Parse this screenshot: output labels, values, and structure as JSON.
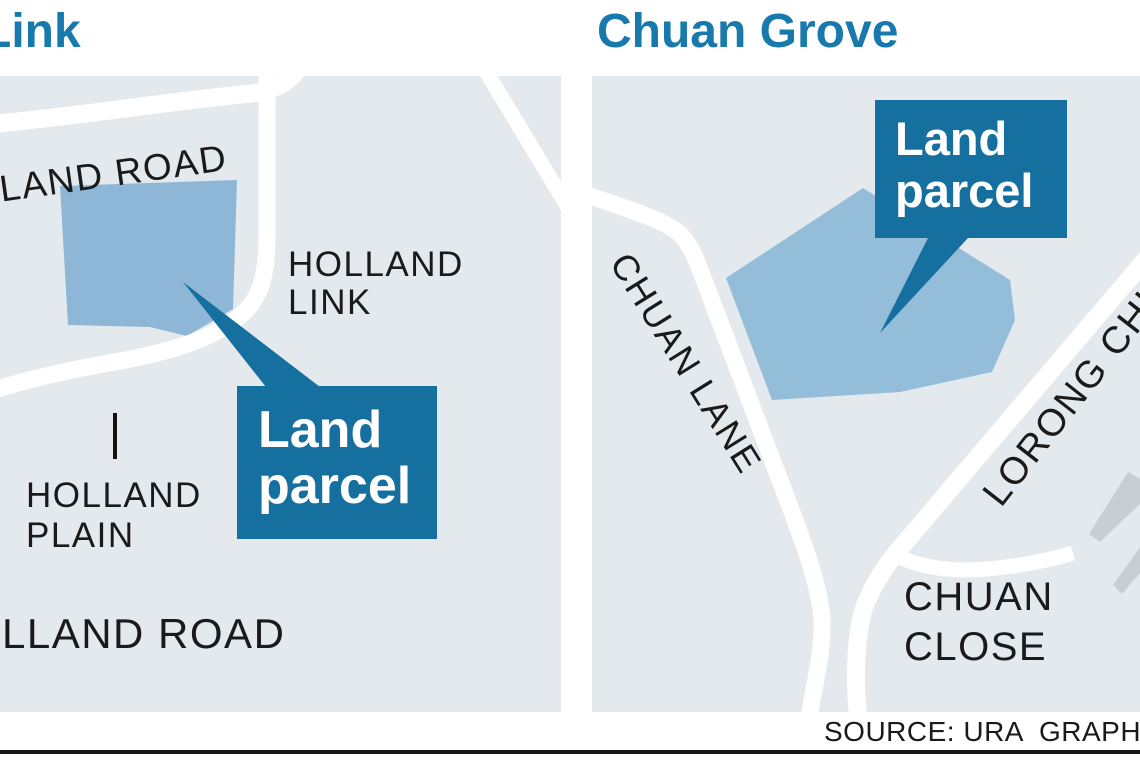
{
  "titles": {
    "left": "Link",
    "right": "Chuan Grove"
  },
  "colors": {
    "title_blue": "#1879ac",
    "accent": "#15709f",
    "map_bg": "#e3e9ed",
    "parcel_left": "#8db6d7",
    "parcel_right": "#94bdda",
    "building": "#c8ced4",
    "road": "#ffffff",
    "ink": "#1a1a1a",
    "rule": "#161616"
  },
  "left_map": {
    "top_road_label": "HOLLAND ROAD",
    "holland_link": {
      "line1": "HOLLAND",
      "line2": "LINK"
    },
    "holland_plain": {
      "line1": "HOLLAND",
      "line2": "PLAIN"
    },
    "bottom_road_label": "HOLLAND ROAD",
    "callout": {
      "line1": "Land",
      "line2": "parcel"
    }
  },
  "right_map": {
    "chuan_lane_label": "CHUAN LANE",
    "lorong_chuan_label": "LORONG CHUAN",
    "chuan_close": {
      "line1": "CHUAN",
      "line2": "CLOSE"
    },
    "callout": {
      "line1": "Land",
      "line2": "parcel"
    }
  },
  "footer": {
    "source": "SOURCE: URA  GRAPHICS"
  }
}
